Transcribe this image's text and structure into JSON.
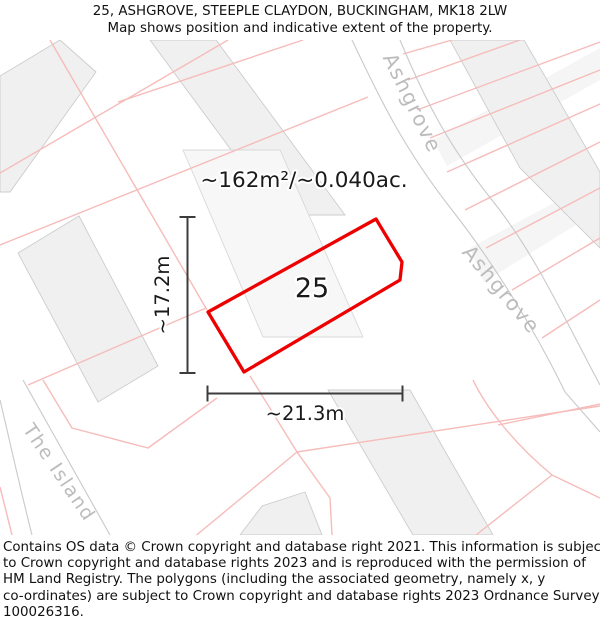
{
  "title": {
    "line1": "25, ASHGROVE, STEEPLE CLAYDON, BUCKINGHAM, MK18 2LW",
    "line2": "Map shows position and indicative extent of the property."
  },
  "map": {
    "area_label": "~162m²/~0.040ac.",
    "plot_number": "25",
    "dimension_width": "~21.3m",
    "dimension_height": "~17.2m",
    "streets": {
      "ashgrove_upper": "Ashgrove",
      "ashgrove_lower": "Ashgrove",
      "the_island": "The Island"
    }
  },
  "footer": {
    "lines": [
      "Contains OS data © Crown copyright and database right 2021. This information is subject",
      "to Crown copyright and database rights 2023 and is reproduced with the permission of",
      "HM Land Registry. The polygons (including the associated geometry, namely x, y",
      "co-ordinates) are subject to Crown copyright and database rights 2023 Ordnance Survey",
      "100026316."
    ]
  },
  "colors": {
    "property-outline": "#ee0000",
    "parcel-line": "#f6bcba",
    "road-edge": "#c9c9c9",
    "building-fill": "#f0f0f0",
    "building-stroke": "#cccccc",
    "street-text": "#bcbcbc",
    "dimension-line": "#3c3c3c",
    "text": "#1a1a1a"
  }
}
